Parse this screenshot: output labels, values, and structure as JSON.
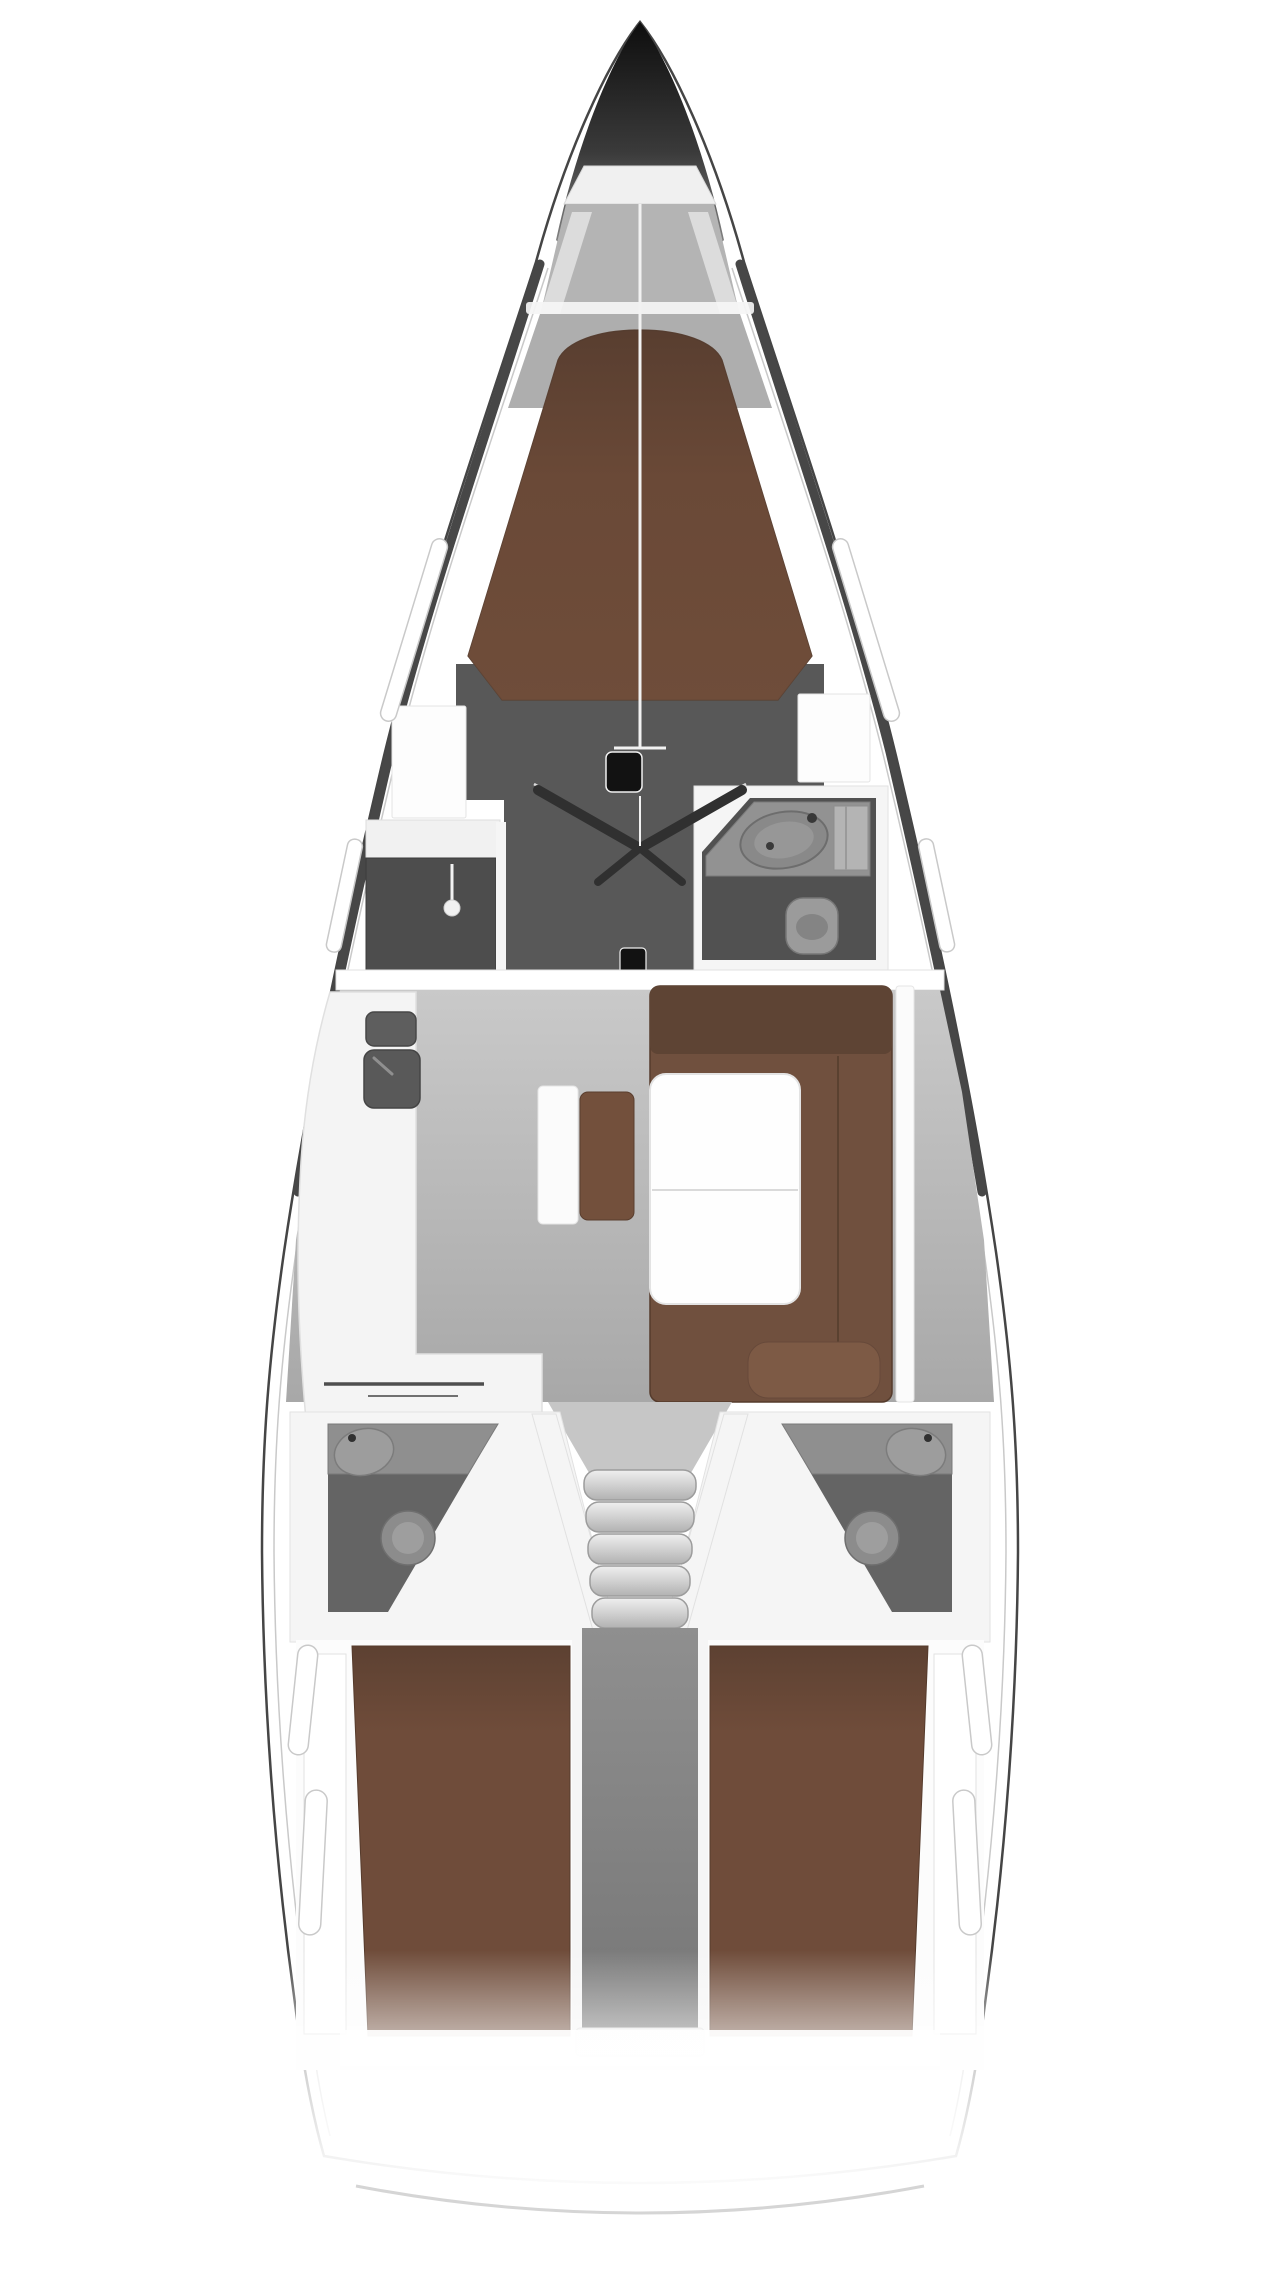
{
  "vessel": {
    "kind": "sailing-yacht-interior-floorplan",
    "orientation": "bow-up",
    "rooms": [
      {
        "id": "anchor-locker",
        "fixtures": [
          "bulkhead",
          "locker-floor",
          "side-steps"
        ]
      },
      {
        "id": "forward-cabin",
        "fixtures": [
          "double-v-berth",
          "wardrobe",
          "side-lockers",
          "double-entry-doors",
          "mast-step"
        ]
      },
      {
        "id": "forward-head",
        "fixtures": [
          "vanity",
          "sink",
          "cabinet",
          "toilet"
        ]
      },
      {
        "id": "salon",
        "fixtures": [
          "galley-counter",
          "stove",
          "galley-sink",
          "u-shaped-sofa",
          "folding-table",
          "center-bench"
        ]
      },
      {
        "id": "companionway",
        "steps": 5
      },
      {
        "id": "aft-head-port",
        "fixtures": [
          "vanity",
          "sink",
          "toilet"
        ]
      },
      {
        "id": "aft-head-starboard",
        "fixtures": [
          "vanity",
          "sink",
          "toilet"
        ]
      },
      {
        "id": "aft-cabin-port",
        "fixtures": [
          "double-berth"
        ]
      },
      {
        "id": "aft-cabin-starboard",
        "fixtures": [
          "double-berth"
        ]
      },
      {
        "id": "engine-compartment",
        "fixtures": []
      },
      {
        "id": "stern-transom",
        "fixtures": [
          "swim-platform-line"
        ]
      }
    ],
    "hull_windows": {
      "bow_pairs": 1,
      "midship_pairs": 1,
      "aft_pairs": 2
    }
  },
  "colors": {
    "page_bg": "#ffffff",
    "hull_fill": "#ffffff",
    "hull_line": "#454545",
    "topsides_band": "#474747",
    "inner_rail": "#c9c9c9",
    "bow_tip": "#0e0e0e",
    "bow_mid": "#3a3a3a",
    "bow_base": "#8e8e8e",
    "locker_bulkhead": "#f0f0f0",
    "locker_floor": "#b4b4b4",
    "locker_strip": "#dcdcdc",
    "chainplate": "#f5f5f5",
    "forepeak_floor": "#aeaeae",
    "cabin_floor_dark": "#585858",
    "berth_fwd_top": "#4a352a",
    "berth_fwd_mid": "#6a4937",
    "berth_fwd_bottom": "#73503c",
    "berth_edge": "#5a4133",
    "side_locker": "#fdfdfd",
    "wardrobe": "#4d4d4d",
    "counter_white": "#f1f1f1",
    "wall_white": "#f5f5f5",
    "wall_edge": "#e0e0e0",
    "head_fwd_floor": "#515151",
    "head_fwd_vanity": "#929292",
    "sink_outer": "#898989",
    "sink_basin": "#979797",
    "cabinet": "#b4b4b4",
    "toilet": "#9b9b9b",
    "toilet_bowl": "#848484",
    "door_leaf": "#303030",
    "centerline": "#f2f2f2",
    "mast": "#121212",
    "bulkhead": "#ffffff",
    "salon_floor_top": "#c9c9c9",
    "salon_floor_bottom": "#a8a8a8",
    "galley": "#f4f4f4",
    "stove": "#5e5e5e",
    "galley_sink": "#595959",
    "fiddle_rail": "#4e4e4e",
    "sofa": "#70503e",
    "sofa_back": "#5e4434",
    "sofa_cushion": "#7d5a45",
    "sofa_edge": "#553b2c",
    "table": "#fefefe",
    "table_edge": "#e3e3e3",
    "bench_back": "#fbfbfb",
    "bench_seat": "#73503c",
    "head_aft_floor": "#646464",
    "head_aft_vanity": "#8f8f8f",
    "head_aft_sink": "#9d9d9d",
    "head_aft_toilet": "#8c8c8c",
    "head_aft_bowl": "#9e9e9e",
    "step_top": "#efefef",
    "step_bottom": "#b2b2b2",
    "step_edge": "#9c9c9c",
    "column_top": "#8f8f8f",
    "column_bottom": "#767676",
    "berth_aft_top": "#5d4132",
    "berth_aft_main": "#6f4c3a",
    "window_fill": "#ffffff",
    "window_edge": "#c9c9c9",
    "transom_line": "#d5d5d5",
    "fade_white": "#ffffff"
  }
}
